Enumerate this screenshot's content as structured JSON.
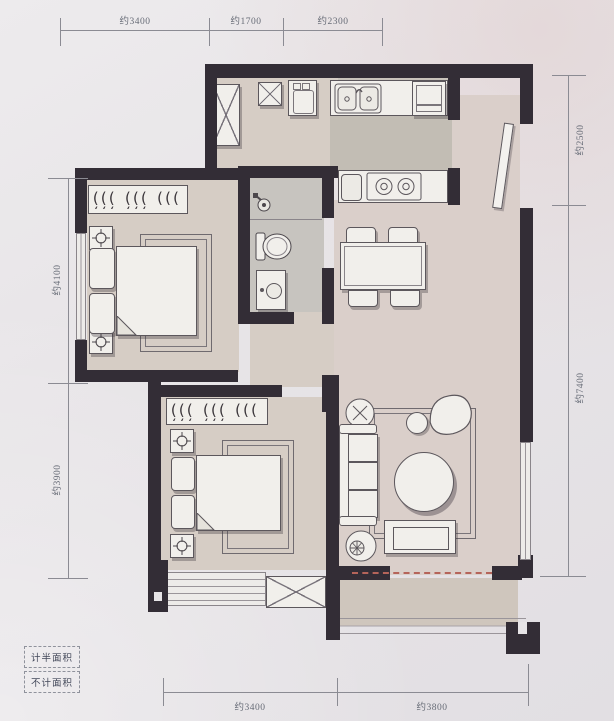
{
  "dimensions": {
    "top": [
      {
        "label": "约3400"
      },
      {
        "label": "约1700"
      },
      {
        "label": "约2300"
      }
    ],
    "right": [
      {
        "label": "约2500"
      },
      {
        "label": "约7400"
      }
    ],
    "left": [
      {
        "label": "约4100"
      },
      {
        "label": "约3900"
      }
    ],
    "bottom": [
      {
        "label": "约3400"
      },
      {
        "label": "约3800"
      }
    ]
  },
  "legend": {
    "items": [
      {
        "label": "计半面积"
      },
      {
        "label": "不计面积"
      }
    ]
  },
  "colors": {
    "paper": "#e7e4e7",
    "wall": "#332d36",
    "floor_warm": "#d6cdc5",
    "floor_cool": "#c9c3bb",
    "floor_cool_dark": "#c2bdb4",
    "furniture": "#f1efeb",
    "outline": "#5c575c",
    "dim_text": "#666b76",
    "dim_line": "#8b8b93",
    "balcony_dash": "#b5645a"
  }
}
